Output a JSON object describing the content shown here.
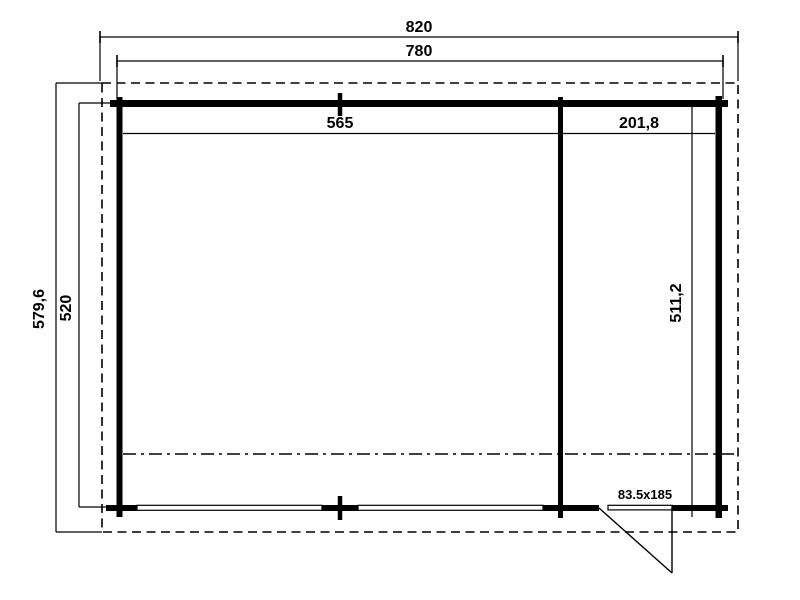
{
  "drawing": {
    "type": "garden-cabin-floor-plan",
    "labels": {
      "roof_width": "820",
      "wall_width": "780",
      "room_left_width": "565",
      "room_right_width": "201,8",
      "total_depth": "579,6",
      "wall_depth": "520",
      "interior_depth": "511,2",
      "door_size": "83.5x185"
    },
    "colors": {
      "line": "#000000",
      "background": "#ffffff"
    }
  }
}
